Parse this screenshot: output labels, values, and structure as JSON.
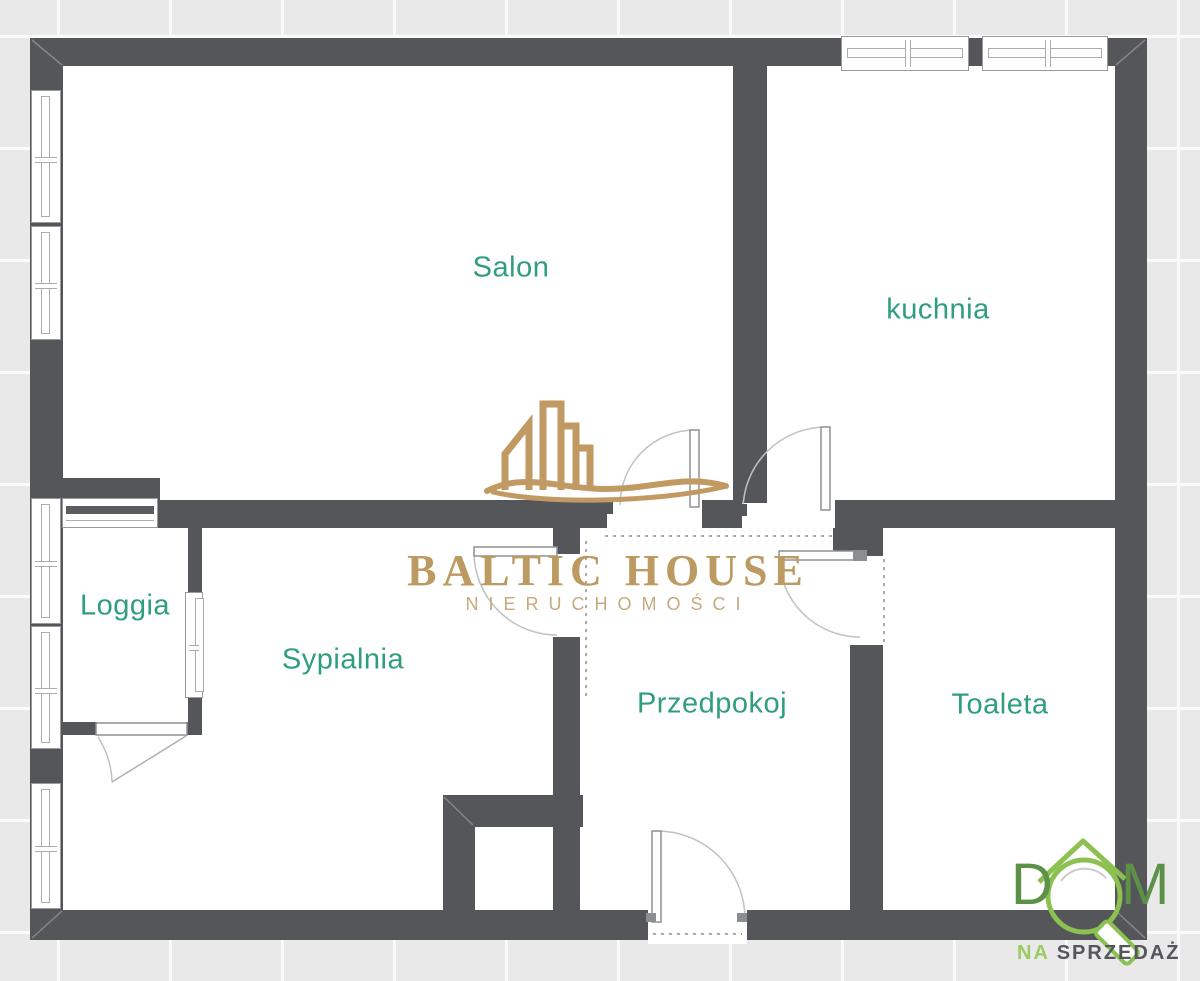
{
  "plan_type": "apartment-floor-plan",
  "rooms": {
    "salon": {
      "label": "Salon"
    },
    "kuchnia": {
      "label": "kuchnia"
    },
    "loggia": {
      "label": "Loggia"
    },
    "sypialnia": {
      "label": "Sypialnia"
    },
    "przedpokoj": {
      "label": "Przedpokoj"
    },
    "toaleta": {
      "label": "Toaleta"
    }
  },
  "watermark": {
    "icon": "building-skyline-icon",
    "title": "BALTIC HOUSE",
    "subtitle": "NIERUCHOMOŚCI"
  },
  "corner_logo": {
    "icon": "house-roof-magnifier-icon",
    "word": "DOM",
    "letter_d": "D",
    "letter_m": "M",
    "tagline_prefix": "NA",
    "tagline_suffix": "SPRZEDAŻ"
  },
  "colors": {
    "wall": "#54565a",
    "room_label_teal": "#2f9e7f",
    "watermark_gold": "#bd9a62",
    "logo_green_dark": "#5d9147",
    "logo_green_light": "#8cc152",
    "outside_background": "#e9e9ea",
    "interior": "#ffffff"
  }
}
